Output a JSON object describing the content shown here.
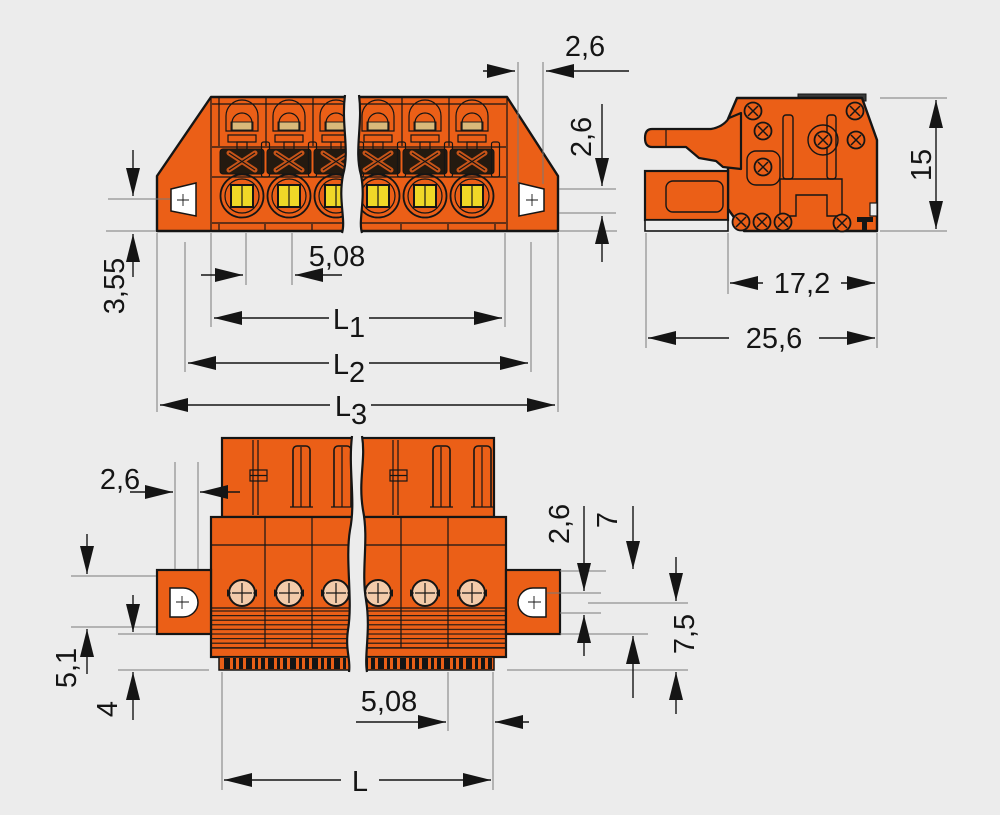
{
  "drawing": {
    "kind": "technical-dimension-drawing",
    "subject": "orange pluggable terminal-block connector with mounting flanges, shown interrupted by break lines",
    "views": [
      "front",
      "side",
      "bottom"
    ]
  },
  "colors": {
    "background": "#ececec",
    "body_orange": "#eb5f17",
    "outline": "#151515",
    "terminal_yellow": "#efd827",
    "screw_beige": "#f3cbaa",
    "clamp_dark": "#241a10",
    "inner_tan": "#d9b97a",
    "extension_line": "#7a7a7a",
    "white": "#ffffff"
  },
  "labels": {
    "front_view": {
      "hole_width": "2,6",
      "hole_height": "2,6",
      "flange_offset": "3,55",
      "pitch": "5,08",
      "length1": "L",
      "length1_sub": "1",
      "length2": "L",
      "length2_sub": "2",
      "length3": "L",
      "length3_sub": "3"
    },
    "side_view": {
      "total_height": "15",
      "housing_depth": "17,2",
      "total_depth": "25,6"
    },
    "bottom_view": {
      "hole_width": "2,6",
      "flange_offset": "5,1",
      "foot_height": "4",
      "hole_height": "2,6",
      "flange_height": "7",
      "strain_relief_height": "7,5",
      "pitch": "5,08",
      "length": "L"
    }
  }
}
